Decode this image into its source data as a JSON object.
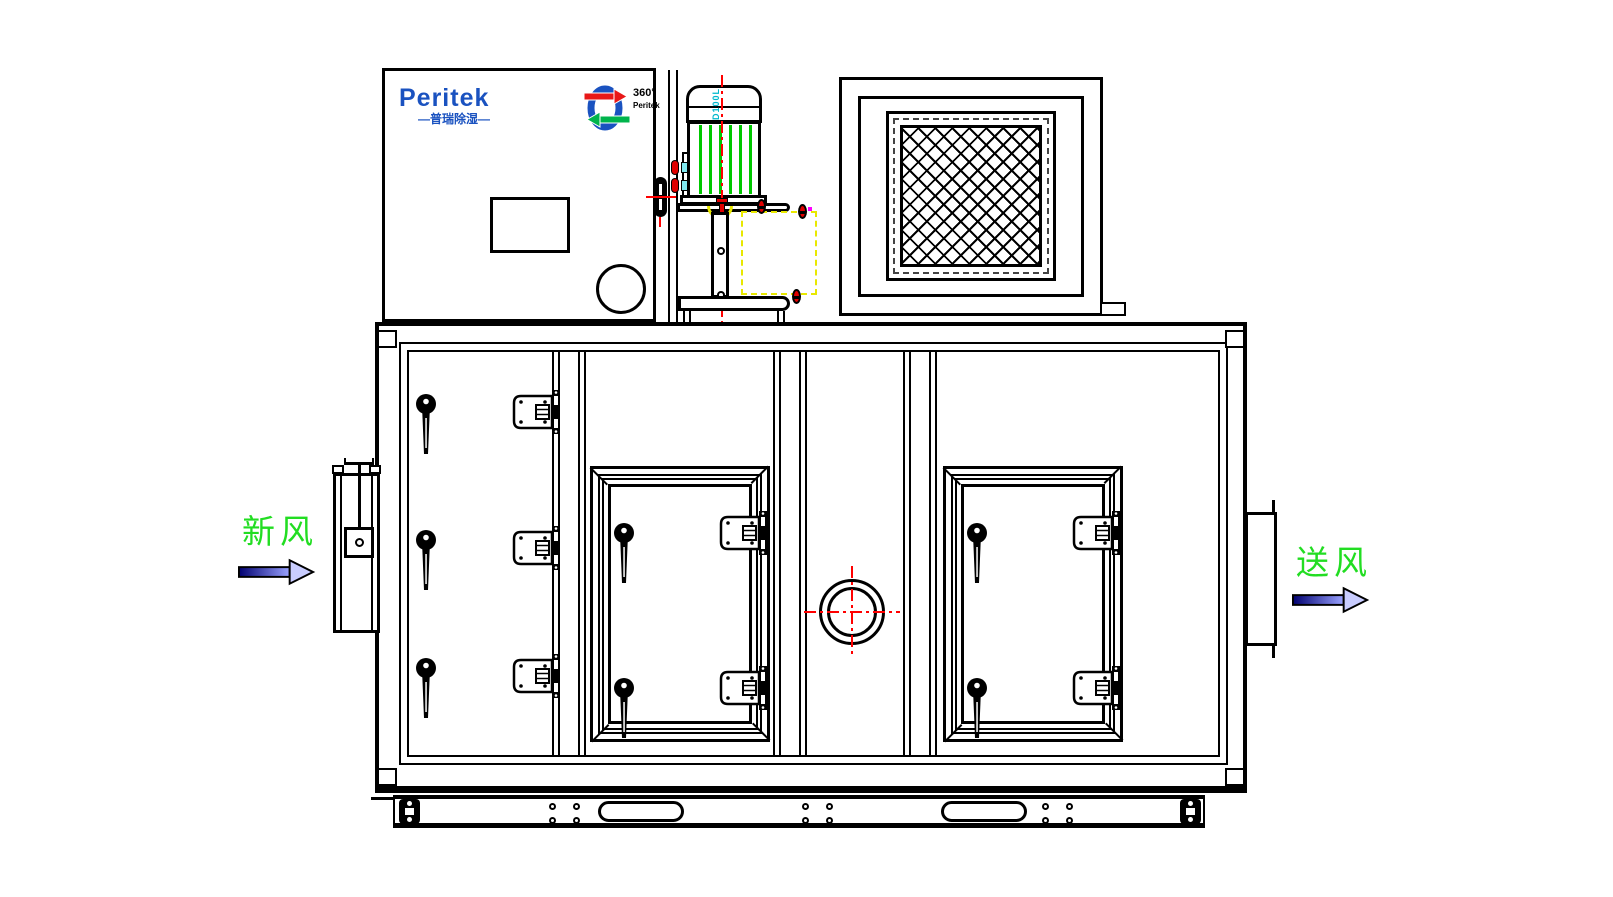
{
  "branding": {
    "logo_text": "Peritek",
    "logo_subtext": "—普瑞除湿—",
    "rotor_badge_line1": "360°",
    "rotor_badge_line2": "Peritek",
    "logo_color": "#1a52c0"
  },
  "annotations": {
    "fresh_air": "新风",
    "supply_air": "送风",
    "motor_frame": "D100L"
  },
  "colors": {
    "line_black": "#000000",
    "centerline_red": "#ff0000",
    "fin_green": "#00c800",
    "marker_yellow": "#e8e800",
    "label_green": "#22dd22",
    "motor_label_cyan": "#00b8cc",
    "logo_blue": "#1a52c0",
    "arrow_dark_blue": "#000070",
    "arrow_light_blue": "#9aa2ff",
    "magenta_marker": "#ff00ff"
  }
}
